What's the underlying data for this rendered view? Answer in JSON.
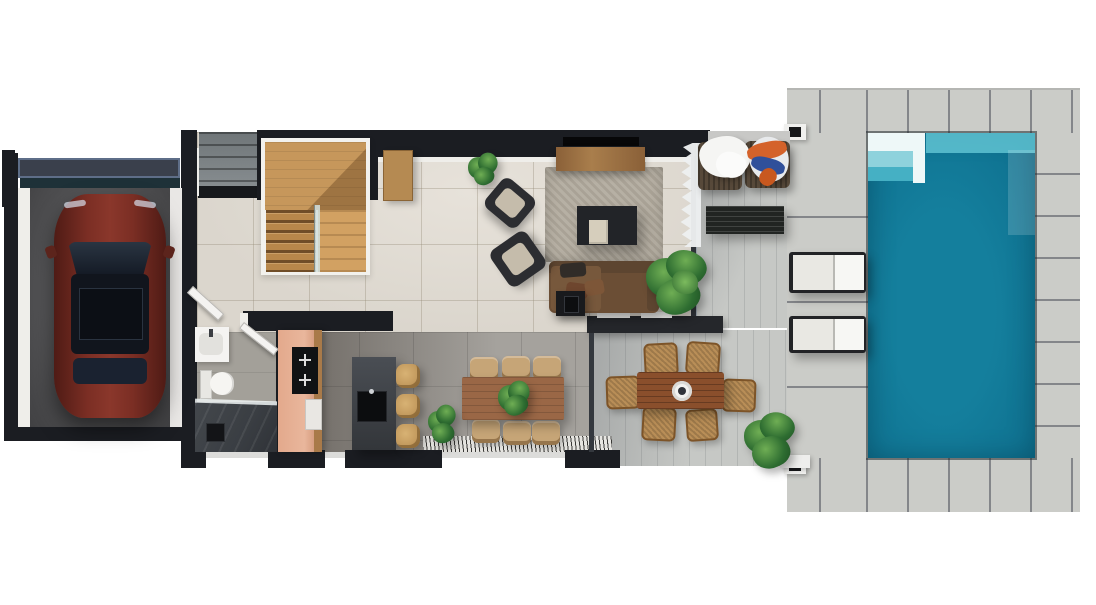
{
  "meta": {
    "view": "top-down 3d floor plan render",
    "width_px": 1096,
    "height_px": 605,
    "visible_text": "none"
  },
  "colors": {
    "wall": "#1b1d22",
    "trim": "#efeeea",
    "floorLiving": "#dbd6cd",
    "floorGrid": "rgba(145,135,115,0.35)",
    "floorDining": "#a5a29d",
    "floorBath": "#a3a099",
    "kitchenShade": "rgba(55,48,42,0.5)",
    "terrace": "#c6c8c5",
    "terraceLine": "rgba(60,65,70,0.14)",
    "deck": "#cbccc8",
    "deckGap": "#84868a",
    "poolMain": "#147f9d",
    "poolDeep": "#0d6d8c",
    "poolLedge": "#5fc3d2",
    "poolStepWhite": "#eef8f8",
    "poolStep2": "#8ed2dc",
    "poolStep3": "#45b0c4",
    "garageFloorHi": "#707072",
    "garageFloorLo": "#414143",
    "garageDoor": "#3a404c",
    "garageDoorFrame": "#5e6e88",
    "garageShadow": "#1e3138",
    "carBodyDark": "#4f1b15",
    "carBody": "#7b2e24",
    "carBodyHi": "#8a372b",
    "carGlass": "#151b26",
    "stepsGray": "#878d90",
    "woodStairs": "#c6975b",
    "woodStairsDark": "#b8874b",
    "woodStairsLight": "#d2a162",
    "woodConsole": "#b58a52",
    "tvConsole": "#a97e4c",
    "tvBlack": "#070708",
    "rug": "#b2ab9e",
    "coffeeTable": "#222428",
    "pouf": "#d6cebc",
    "sofa": "#6b4e35",
    "sofaDark": "#5d4530",
    "sideTable": "#191a1d",
    "accentChair": "#2c2d31",
    "accentCushion": "#c5bcab",
    "halfWall": "#25272b",
    "curtain": "#eef0f1",
    "patioTable": "#212422",
    "towelWhite": "#f5f5f3",
    "towelOrange": "#d4622a",
    "towelBlue": "#30509a",
    "rattan": "#b98e57",
    "rattanDark": "#7d5428",
    "outdoorTable": "#8a4f2c",
    "salmon": "#e9b69c",
    "salmonDark": "#c98c6b",
    "counterWood": "#a97a49",
    "cooktop": "#101214",
    "island": "#42464c",
    "islandDark": "#33363a",
    "sink": "#0c0d0f",
    "stool": "#b4894e",
    "stoolHi": "#d8b274",
    "chairTan": "#c6a577",
    "diningTable": "#9a6746",
    "shower": "#3a3e43",
    "drain": "#131417",
    "white": "#f4f3f1",
    "lounger": "#e9e8e3",
    "loungerFrame": "#222326",
    "plantLight": "#6fae54",
    "plantMid": "#2e6d31",
    "plantDark": "#1d4e22",
    "beamLight": "#c8c8c6"
  },
  "inventory": {
    "rooms": [
      "garage",
      "entry-steps",
      "stairwell",
      "living-room",
      "kitchen",
      "bathroom",
      "indoor-dining",
      "covered-terrace",
      "outdoor-dining",
      "pool-deck",
      "pool"
    ],
    "furniture": [
      "car",
      "staircase",
      "console-table",
      "tv",
      "tv-console",
      "rug",
      "coffee-table",
      "pouf",
      "sofa",
      "side-table",
      "accent-chair",
      "accent-chair",
      "curtain",
      "patio-armchair",
      "patio-armchair",
      "patio-slat-table",
      "outdoor-dining-table",
      "outdoor-dining-chairs",
      "kitchen-counter",
      "cooktop",
      "kitchen-island",
      "sink",
      "bar-stools",
      "vanity-sink",
      "toilet",
      "shower",
      "dining-table",
      "dining-chairs",
      "fringe-rug",
      "sun-lounger",
      "sun-lounger",
      "deck-lights",
      "pool-steps"
    ],
    "counts": {
      "stair-flights": 2,
      "indoor-dining-chairs": 6,
      "outdoor-dining-chairs": 6,
      "bar-stools": 3,
      "sun-loungers": 2,
      "patio-armchairs": 2,
      "plants": 6
    }
  }
}
